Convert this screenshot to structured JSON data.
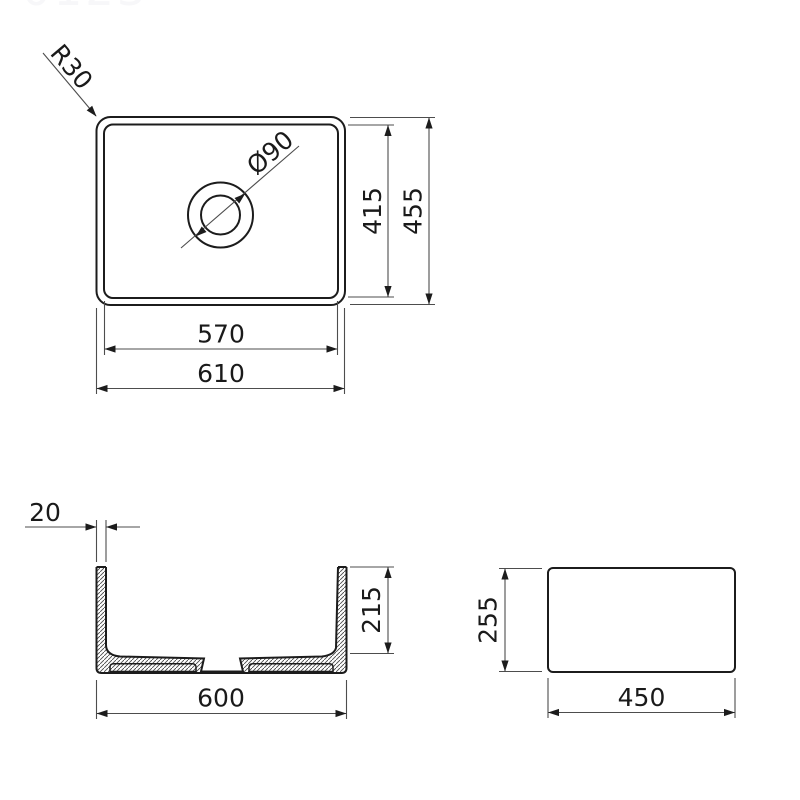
{
  "watermark": "0123",
  "drawing": {
    "top_view": {
      "corner_radius_label": "R30",
      "drain_diameter_label": "Ø90",
      "inner_height_label": "415",
      "outer_height_label": "455",
      "inner_width_label": "570",
      "outer_width_label": "610"
    },
    "front_section_view": {
      "wall_thickness_label": "20",
      "inner_depth_label": "215",
      "outer_width_label": "600"
    },
    "side_view": {
      "height_label": "255",
      "width_label": "450"
    }
  },
  "colors": {
    "outline": "#1c1c1c",
    "dimension_line": "#4d4d4d",
    "text": "#1a1a1a",
    "watermark": "#f7f7f9",
    "background": "#ffffff"
  }
}
